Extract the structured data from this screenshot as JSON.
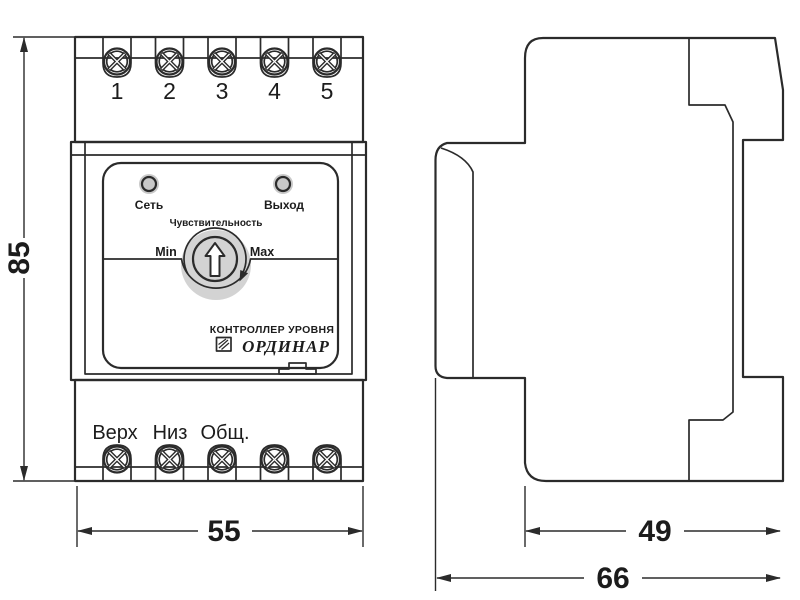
{
  "front_view": {
    "terminals_top": [
      "1",
      "2",
      "3",
      "4",
      "5"
    ],
    "terminals_bottom": [
      "Верх",
      "Низ",
      "Общ."
    ],
    "led_power_label": "Сеть",
    "led_output_label": "Выход",
    "sensitivity_label": "Чувствительность",
    "min_label": "Min",
    "max_label": "Max",
    "device_type_label": "КОНТРОЛЛЕР УРОВНЯ",
    "brand_label": "ОРДИНАР"
  },
  "dimensions": {
    "height_mm": "85",
    "width_mm": "55",
    "body_depth_mm": "49",
    "total_depth_mm": "66"
  },
  "colors": {
    "line": "#2b2b2b",
    "knob_fill": "#d3d3d3",
    "led_halo": "#c9c9c9",
    "background": "#ffffff"
  }
}
